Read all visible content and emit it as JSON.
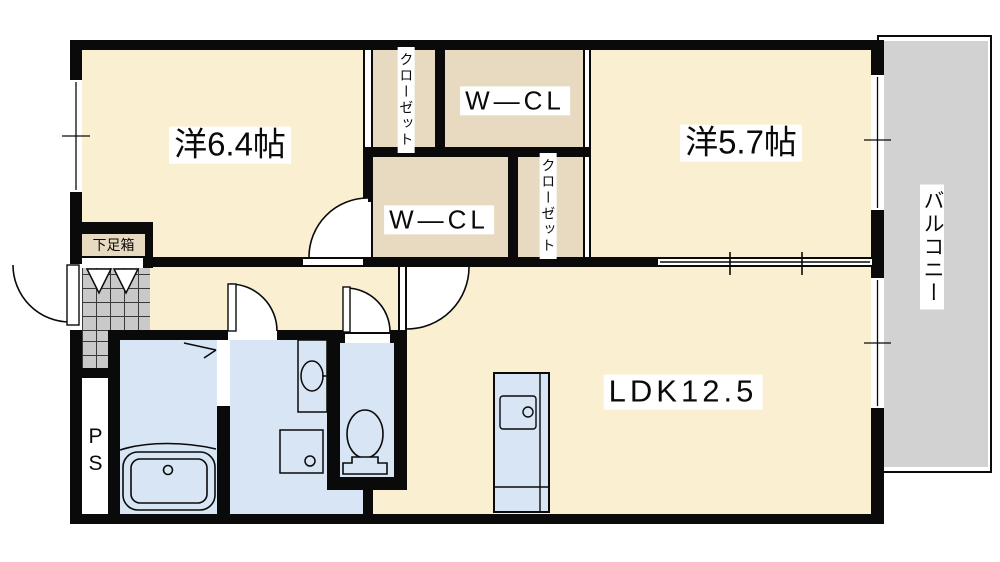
{
  "plan": {
    "type": "apartment-floor-plan",
    "rooms": {
      "bedroom1": {
        "label": "洋6.4帖"
      },
      "bedroom2": {
        "label": "洋5.7帖"
      },
      "ldk": {
        "label": "LDK12.5"
      },
      "wcl_top": {
        "label": "W—CL"
      },
      "wcl_bottom": {
        "label": "W—CL"
      },
      "closet1": {
        "label": "クローゼット"
      },
      "closet2": {
        "label": "クローゼット"
      },
      "balcony": {
        "label": "バルコニー"
      },
      "shoe_box": {
        "label": "下足箱"
      },
      "pipe_space": {
        "label": "PS"
      }
    },
    "colors": {
      "floor_cream": "#FAEFD1",
      "closet_tan": "#E7DAC0",
      "wet_area_blue": "#D8E5F4",
      "balcony_grey": "#D2D2D2",
      "entrance_tile_grey": "#C9C9C9",
      "wall_black": "#0A0A0A",
      "label_background": "#FFFFFF"
    }
  }
}
